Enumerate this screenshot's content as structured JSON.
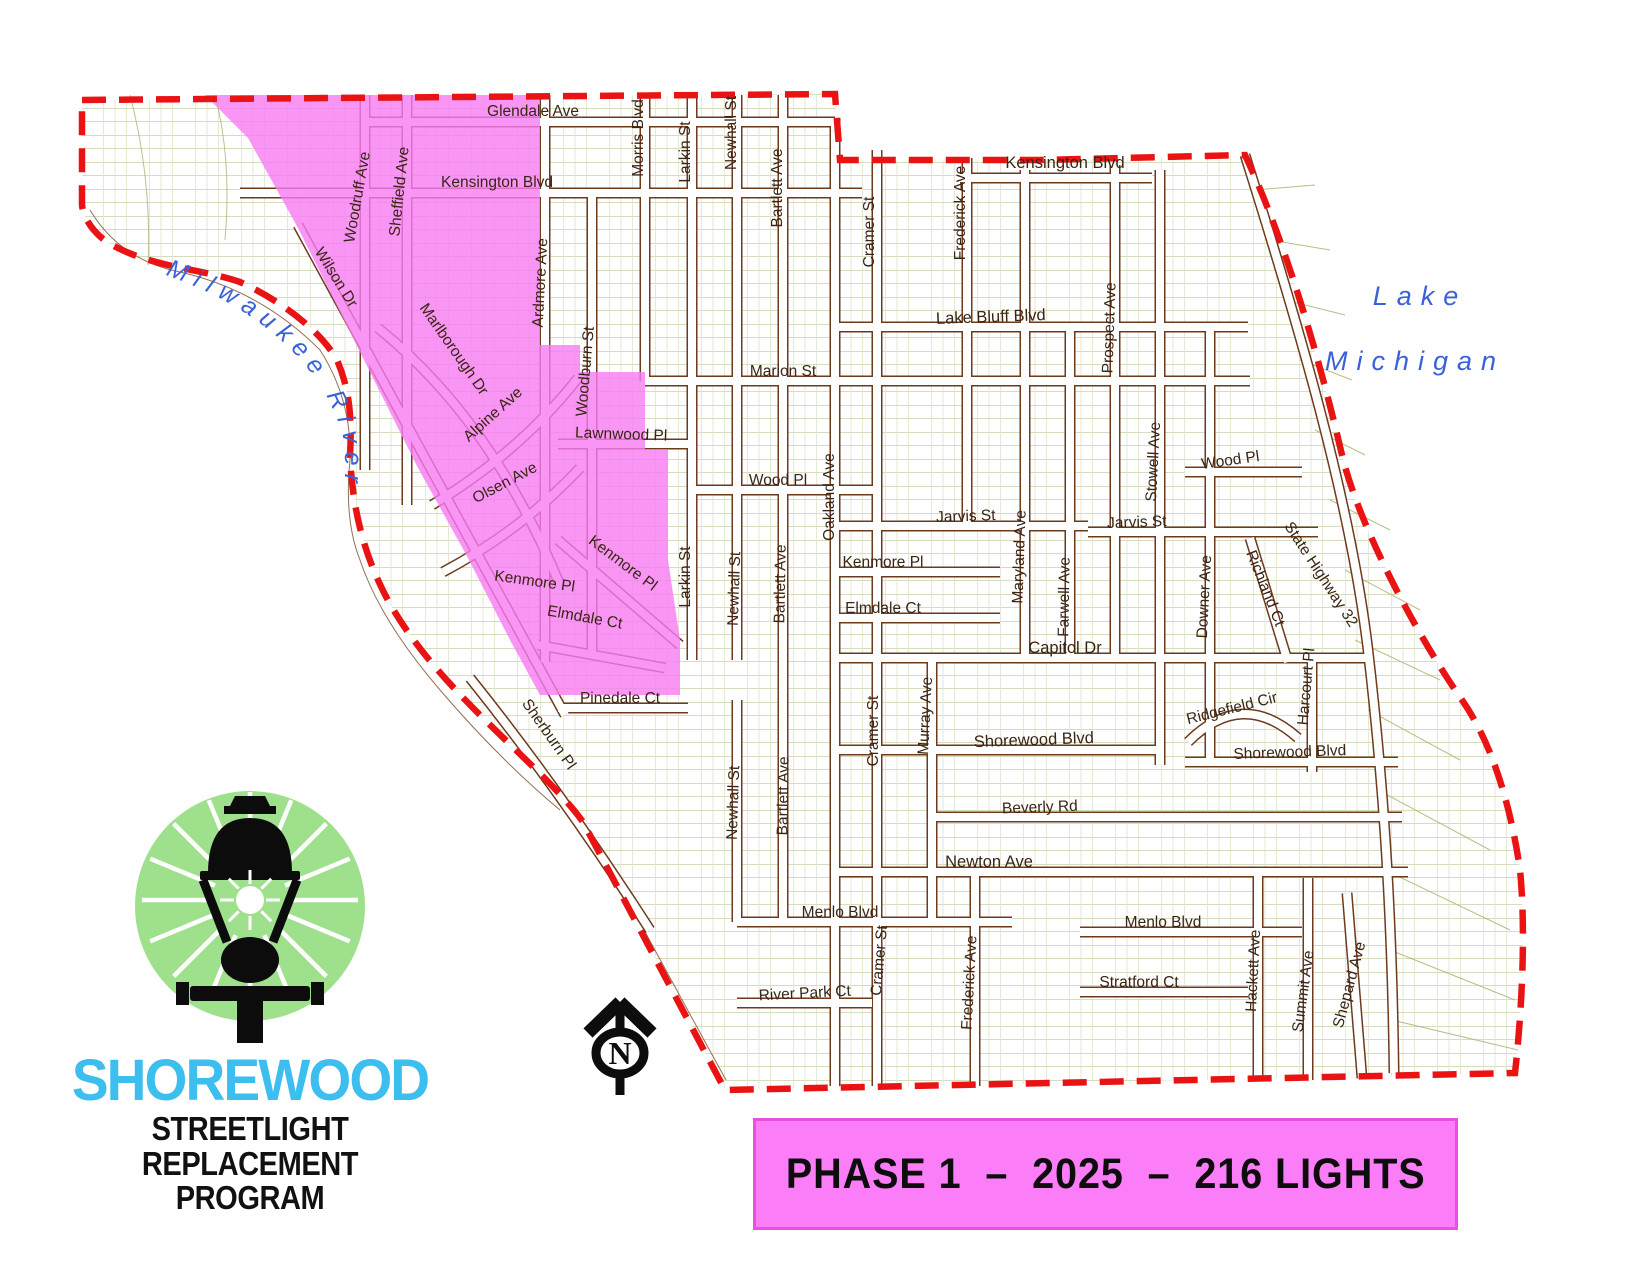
{
  "map": {
    "water_labels": {
      "river": "Milwaukee River",
      "lake_line1": "Lake",
      "lake_line2": "Michigan"
    },
    "street_labels": [
      "Glendale Ave",
      "Kensington Blvd",
      "Morris Blvd",
      "Larkin St",
      "Newhall St",
      "Bartlett Ave",
      "Cramer St",
      "Frederick Ave",
      "Kensington Blvd",
      "Woodruff Ave",
      "Sheffield Ave",
      "Wilson Dr",
      "Ardmore Ave",
      "Marlborough Dr",
      "Alpine Ave",
      "Olsen Ave",
      "Woodburn St",
      "Lake Bluff Blvd",
      "Marion St",
      "Prospect Ave",
      "Lawnwood Pl",
      "Wood Pl",
      "Oakland Ave",
      "Stowell Ave",
      "Wood Pl",
      "Jarvis St",
      "Jarvis St",
      "Maryland Ave",
      "Farwell Ave",
      "Larkin St",
      "Newhall St",
      "Bartlett Ave",
      "Kenmore Pl",
      "Kenmore Pl",
      "Kenmore Pl",
      "Elmdale Ct",
      "Elmdale Ct",
      "Downer Ave",
      "Richland Ct",
      "State Highway 32",
      "Capitol Dr",
      "Harcourt Pl",
      "Ridgefield Cir",
      "Pinedale Ct",
      "Sherburn Pl",
      "Cramer St",
      "Murray Ave",
      "Shorewood Blvd",
      "Shorewood Blvd",
      "Newhall St",
      "Bartlett Ave",
      "Beverly Rd",
      "Newton Ave",
      "Menlo Blvd",
      "Menlo Blvd",
      "Cramer St",
      "Frederick Ave",
      "Stratford Ct",
      "Hackett Ave",
      "Summit Ave",
      "Shepard Ave",
      "River Park Ct"
    ]
  },
  "logo": {
    "name": "SHOREWOOD",
    "subtitle1": "STREETLIGHT REPLACEMENT",
    "subtitle2": "PROGRAM"
  },
  "banner": {
    "text": "PHASE 1  –  2025  –  216 LIGHTS"
  },
  "north_arrow": {
    "label": "N"
  },
  "colors": {
    "phase1_area": "#F87CF2",
    "boundary_red": "#EA1313",
    "banner_pink": "#FB7DF8",
    "banner_border": "#E94FE0",
    "logo_green": "#9FE08C",
    "brand_cyan": "#3CBEEE",
    "water_text_blue": "#3A62D8",
    "road_brown": "#6E3A1C",
    "parcel_olive": "#B5BF8A",
    "label_brown": "#3A2414"
  }
}
